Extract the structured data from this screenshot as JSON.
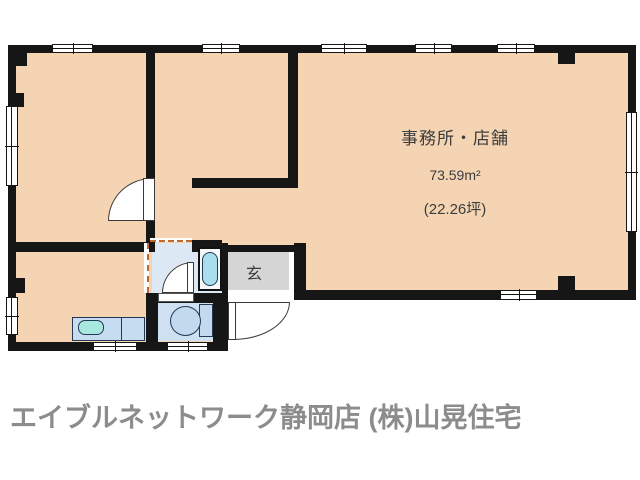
{
  "plan": {
    "office": {
      "label": "事務所・店舗",
      "area_m2": "73.59m²",
      "area_tsubo": "(22.26坪)"
    },
    "entrance": {
      "label": "玄"
    },
    "footer": {
      "agency_text": "エイブルネットワーク静岡店 (株)山晃住宅"
    },
    "colors": {
      "floor_main": "#F4D4B2",
      "wall": "#161616",
      "washroom_floor": "#DCE9F5",
      "toilet_floor": "#CEE0F2",
      "counter_fill": "#C6DCF0",
      "entrance_floor": "#D5D5D5",
      "sink_fill": "#A9E8DF",
      "bathtub_fill": "#A9DFEC",
      "fixture_fill": "#C3D9EE",
      "opening_dash": "#C2672F",
      "footer_text": "#8C8C8C",
      "room_label_text": "#3C3C3C"
    }
  }
}
